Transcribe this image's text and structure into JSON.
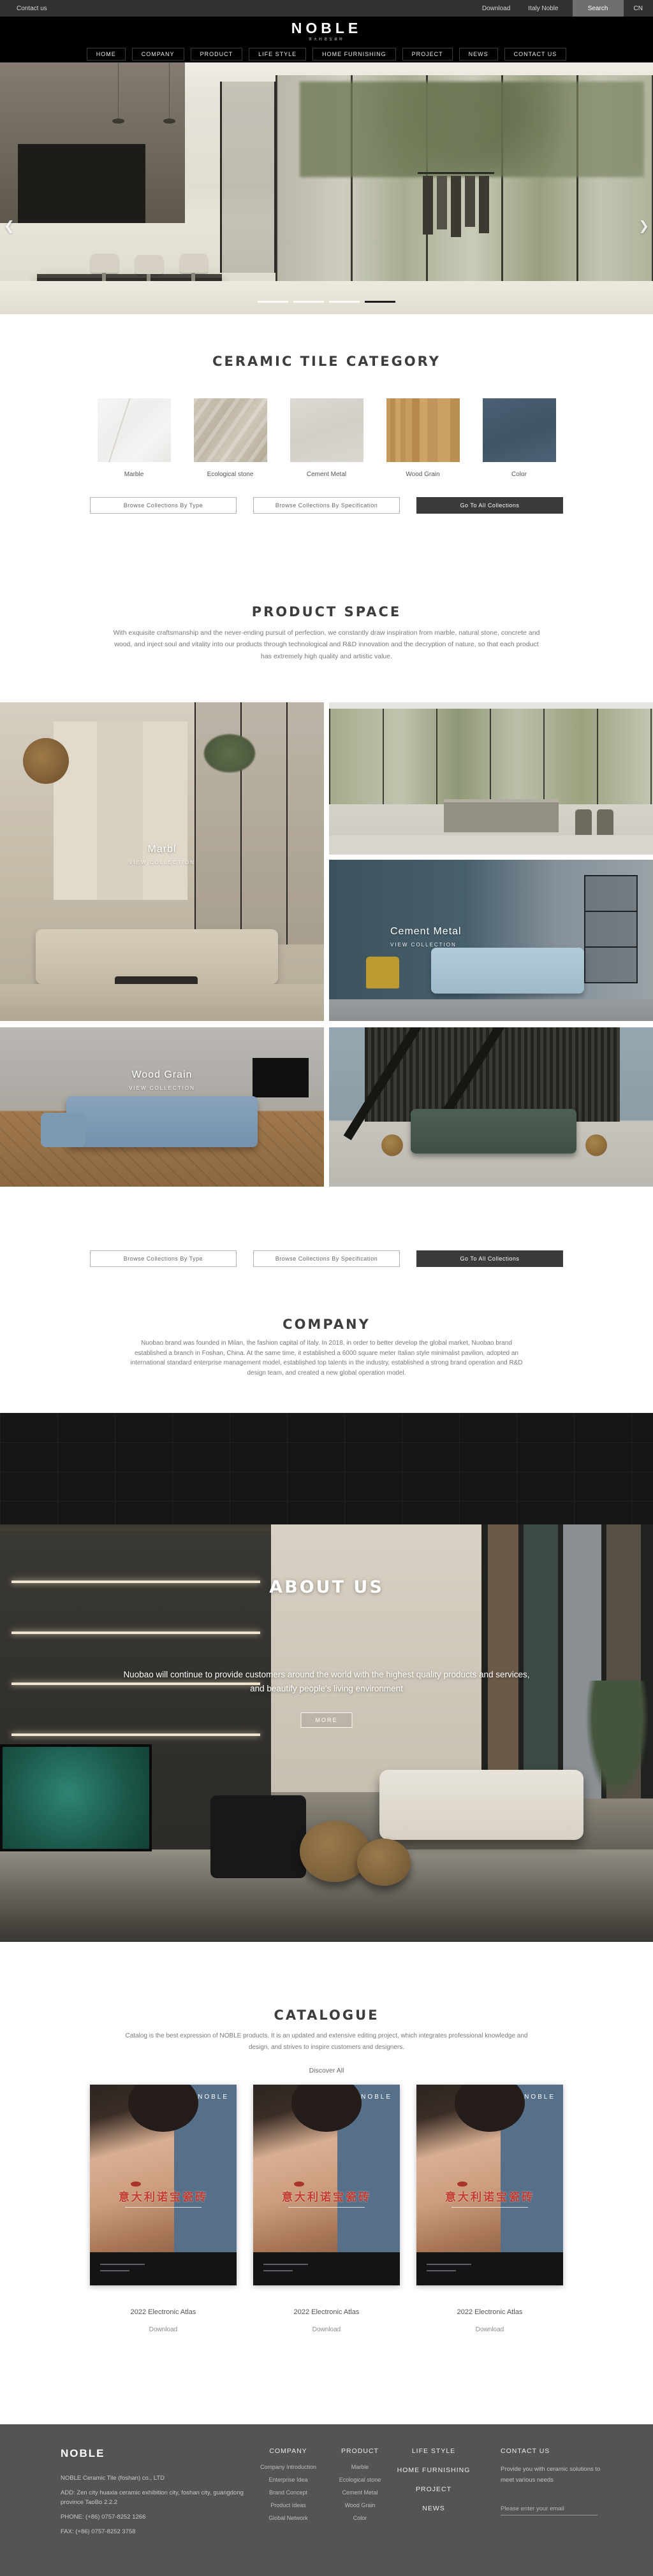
{
  "topbar": {
    "contact": "Contact us",
    "download": "Download",
    "italy_noble": "Italy Noble",
    "search": "Search",
    "lang": "CN"
  },
  "header": {
    "logo": "NOBLE",
    "logo_sub": "意大利诺宝瓷砖"
  },
  "nav": {
    "items": [
      "HOME",
      "COMPANY",
      "PRODUCT",
      "LIFE STYLE",
      "HOME FURNISHING",
      "PROJECT",
      "NEWS",
      "CONTACT US"
    ]
  },
  "hero": {
    "prev_icon": "❮",
    "next_icon": "❯",
    "pagination": {
      "count": 4,
      "active_index": 4
    }
  },
  "category": {
    "title": "CERAMIC TILE CATEGORY",
    "items": [
      {
        "label": "Marble",
        "swatch": "#f2f1ef"
      },
      {
        "label": "Ecological stone",
        "swatch": "#c4bbaa"
      },
      {
        "label": "Cement Metal",
        "swatch": "#d7d4ce"
      },
      {
        "label": "Wood Grain",
        "swatch": "#c2975c"
      },
      {
        "label": "Color",
        "swatch": "#475a6e"
      }
    ]
  },
  "collection_buttons": {
    "by_type": "Browse Collections By Type",
    "by_spec": "Browse Collections By Specification",
    "all": "Go To All Collections"
  },
  "product_space": {
    "title": "PRODUCT SPACE",
    "description": "With exquisite craftsmanship and the never-ending pursuit of perfection, we constantly draw inspiration from marble, natural stone, concrete and wood, and inject soul and vitality into our products through technological and R&D innovation and the decryption of nature, so that each product has extremely high quality and artistic value.",
    "tiles": [
      {
        "name": "Marbl",
        "cta": "VIEW COLLECTION"
      },
      {
        "name": "Cement Metal",
        "cta": "VIEW COLLECTION"
      },
      {
        "name": "Wood Grain",
        "cta": "VIEW COLLECTION"
      }
    ]
  },
  "company": {
    "title": "COMPANY",
    "description": "Nuobao brand was founded in Milan, the fashion capital of Italy. In 2018, in order to better develop the global market, Nuobao brand established a branch in Foshan, China. At the same time, it established a 6000 square meter Italian style minimalist pavilion, adopted an international standard enterprise management model, established top talents in the industry, established a strong brand operation and R&D design team, and created a new global operation model."
  },
  "about": {
    "title": "ABOUT US",
    "line1": "Nuobao will continue to provide customers around the world with the highest quality products and services,",
    "line2": "and beautify people's living environment",
    "more": "MORE"
  },
  "catalogue": {
    "title": "CATALOGUE",
    "description": "Catalog is the best expression of NOBLE products. It is an updated and extensive editing project, which integrates professional knowledge and design, and strives to inspire customers and designers.",
    "discover": "Discover All",
    "items": [
      {
        "title": "2022 Electronic Atlas",
        "action": "Download",
        "cover_brand": "NOBLE",
        "cover_text": "意大利诺宝瓷砖"
      },
      {
        "title": "2022 Electronic Atlas",
        "action": "Download",
        "cover_brand": "NOBLE",
        "cover_text": "意大利诺宝瓷砖"
      },
      {
        "title": "2022 Electronic Atlas",
        "action": "Download",
        "cover_brand": "NOBLE",
        "cover_text": "意大利诺宝瓷砖"
      }
    ]
  },
  "footer": {
    "brand": "NOBLE",
    "company_name": "NOBLE Ceramic Tile (foshan) co., LTD",
    "address": "ADD:  Zen city huaxia ceramic exhibition city, foshan city, guangdong province TaoBo 2.2.2",
    "phone": "PHONE:   (+86)  0757-8252 1266",
    "fax": "FAX:   (+86)  0757-8252 3758",
    "col_company": {
      "header": "COMPANY",
      "links": [
        "Company Introduction",
        "Enterprise Idea",
        "Brand Concept",
        "Product Ideas",
        "Global Network"
      ]
    },
    "col_product": {
      "header": "PRODUCT",
      "links": [
        "Marble",
        "Ecological stone",
        "Cement Metal",
        "Wood Grain",
        "Color"
      ]
    },
    "col_nav": {
      "links": [
        "LIFE STYLE",
        "HOME FURNISHING",
        "PROJECT",
        "NEWS"
      ]
    },
    "col_contact": {
      "header": "CONTACT US",
      "blurb": "Provide you with ceramic solutions to meet various needs",
      "email_placeholder": "Please enter your email"
    }
  }
}
